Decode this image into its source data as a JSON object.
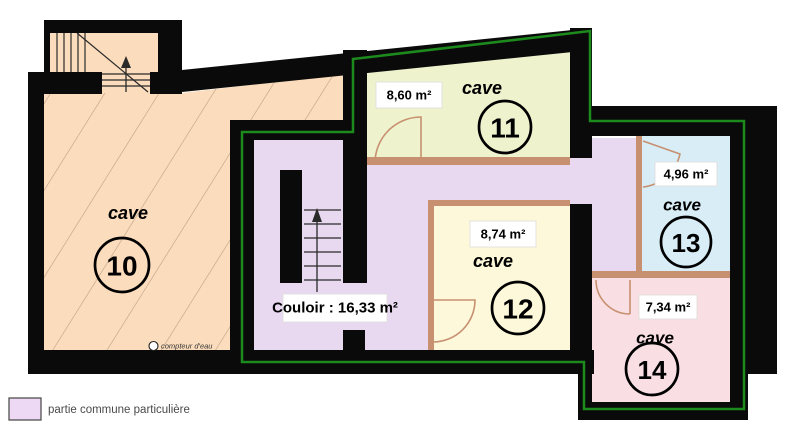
{
  "plan": {
    "rooms": [
      {
        "number": "10",
        "type_label": "cave",
        "color": "#fbdcbc"
      },
      {
        "number": "11",
        "type_label": "cave",
        "area_label": "8,60 m²",
        "color": "#eef3cd"
      },
      {
        "number": "12",
        "type_label": "cave",
        "area_label": "8,74 m²",
        "color": "#fdf8da"
      },
      {
        "number": "13",
        "type_label": "cave",
        "area_label": "4,96 m²",
        "color": "#d8edf6"
      },
      {
        "number": "14",
        "type_label": "cave",
        "area_label": "7,34 m²",
        "color": "#f9dfe3"
      }
    ],
    "corridor": {
      "label": "Couloir : 16,33 m²",
      "color": "#e9d9f0"
    },
    "water_meter_label": "compteur d'eau",
    "legend": {
      "label": "partie commune particulière",
      "swatch_color": "#eed9f4"
    },
    "outline_color": "#1d8a1d",
    "partition_color": "#c79070"
  }
}
